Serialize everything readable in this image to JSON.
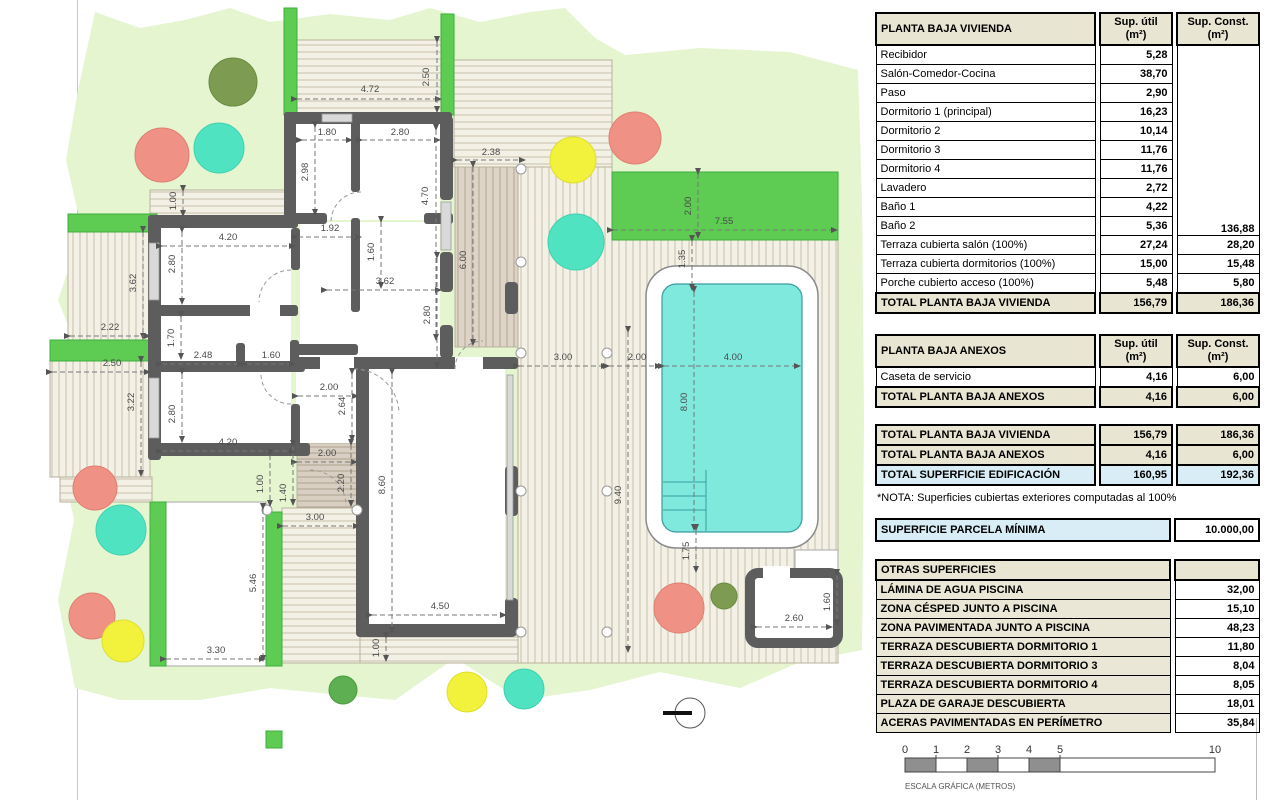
{
  "plan": {
    "dims": [
      "4.72",
      "2.50",
      "1.80",
      "2.80",
      "2.38",
      "2.98",
      "4.70",
      "6.00",
      "1.92",
      "1.60",
      "3.62",
      "2.80",
      "1.00",
      "4.20",
      "2.80",
      "3.62",
      "2.22",
      "1.70",
      "2.48",
      "1.60",
      "2.50",
      "3.22",
      "2.80",
      "4.20",
      "2.00",
      "2.64",
      "2.00",
      "2.20",
      "1.00",
      "1.40",
      "8.60",
      "3.00",
      "5.46",
      "3.30",
      "4.50",
      "1.00",
      "9.40",
      "3.00",
      "2.00",
      "4.00",
      "8.00",
      "2.00",
      "7.55",
      "1.35",
      "1.75",
      "2.60",
      "1.60"
    ],
    "scale": [
      "0",
      "1",
      "2",
      "3",
      "4",
      "5",
      "10"
    ],
    "scale_caption": "ESCALA GRÁFICA (METROS)",
    "colors": {
      "lawn": "#e4f5d0",
      "hedge": "#5ecb52",
      "pool_water": "#7fe9de",
      "wall": "#5d5d5d",
      "tree_salmon": "#ef9184",
      "tree_yellow": "#f2f23c",
      "tree_turquoise": "#4fe3c1",
      "tree_olive": "#7d9c52",
      "table_header": "#e8e5d2",
      "table_highlight": "#d8edf5"
    }
  },
  "tables": {
    "vivienda": {
      "title": "PLANTA BAJA VIVIENDA",
      "col_util_1": "Sup. útil",
      "col_util_2": "(m²)",
      "col_const_1": "Sup. Const.",
      "col_const_2": "(m²)",
      "rows": [
        {
          "label": "Recibidor",
          "util": "5,28"
        },
        {
          "label": "Salón-Comedor-Cocina",
          "util": "38,70"
        },
        {
          "label": "Paso",
          "util": "2,90"
        },
        {
          "label": "Dormitorio 1 (principal)",
          "util": "16,23"
        },
        {
          "label": "Dormitorio 2",
          "util": "10,14"
        },
        {
          "label": "Dormitorio 3",
          "util": "11,76"
        },
        {
          "label": "Dormitorio 4",
          "util": "11,76"
        },
        {
          "label": "Lavadero",
          "util": "2,72"
        },
        {
          "label": "Baño 1",
          "util": "4,22"
        },
        {
          "label": "Baño 2",
          "util": "5,36"
        },
        {
          "label": "Terraza cubierta salón (100%)",
          "util": "27,24",
          "konst": "28,20"
        },
        {
          "label": "Terraza cubierta dormitorios (100%)",
          "util": "15,00",
          "konst": "15,48"
        },
        {
          "label": "Porche cubierto acceso (100%)",
          "util": "5,48",
          "konst": "5,80"
        }
      ],
      "merged_const": "136,88",
      "total": {
        "label": "TOTAL PLANTA BAJA VIVIENDA",
        "util": "156,79",
        "konst": "186,36"
      }
    },
    "anexos": {
      "title": "PLANTA BAJA ANEXOS",
      "col_util_1": "Sup. útil",
      "col_util_2": "(m²)",
      "col_const_1": "Sup. Const.",
      "col_const_2": "(m²)",
      "rows": [
        {
          "label": "Caseta de servicio",
          "util": "4,16",
          "konst": "6,00"
        }
      ],
      "total": {
        "label": "TOTAL PLANTA BAJA ANEXOS",
        "util": "4,16",
        "konst": "6,00"
      }
    },
    "resumen": {
      "rows": [
        {
          "label": "TOTAL PLANTA BAJA VIVIENDA",
          "util": "156,79",
          "konst": "186,36"
        },
        {
          "label": "TOTAL PLANTA BAJA ANEXOS",
          "util": "4,16",
          "konst": "6,00"
        },
        {
          "label": "TOTAL SUPERFICIE EDIFICACIÓN",
          "util": "160,95",
          "konst": "192,36"
        }
      ],
      "nota": "*NOTA: Superficies cubiertas exteriores computadas al 100%"
    },
    "parcela": {
      "label": "SUPERFICIE PARCELA MÍNIMA",
      "value": "10.000,00"
    },
    "otras": {
      "title": "OTRAS SUPERFICIES",
      "rows": [
        {
          "label": "LÁMINA DE AGUA PISCINA",
          "value": "32,00"
        },
        {
          "label": "ZONA CÉSPED JUNTO A PISCINA",
          "value": "15,10"
        },
        {
          "label": "ZONA PAVIMENTADA JUNTO A PISCINA",
          "value": "48,23"
        },
        {
          "label": "TERRAZA DESCUBIERTA DORMITORIO 1",
          "value": "11,80"
        },
        {
          "label": "TERRAZA DESCUBIERTA DORMITORIO 3",
          "value": "8,04"
        },
        {
          "label": "TERRAZA DESCUBIERTA DORMITORIO 4",
          "value": "8,05"
        },
        {
          "label": "PLAZA DE GARAJE DESCUBIERTA",
          "value": "18,01"
        },
        {
          "label": "ACERAS PAVIMENTADAS EN PERÍMETRO",
          "value": "35,84"
        }
      ]
    }
  }
}
